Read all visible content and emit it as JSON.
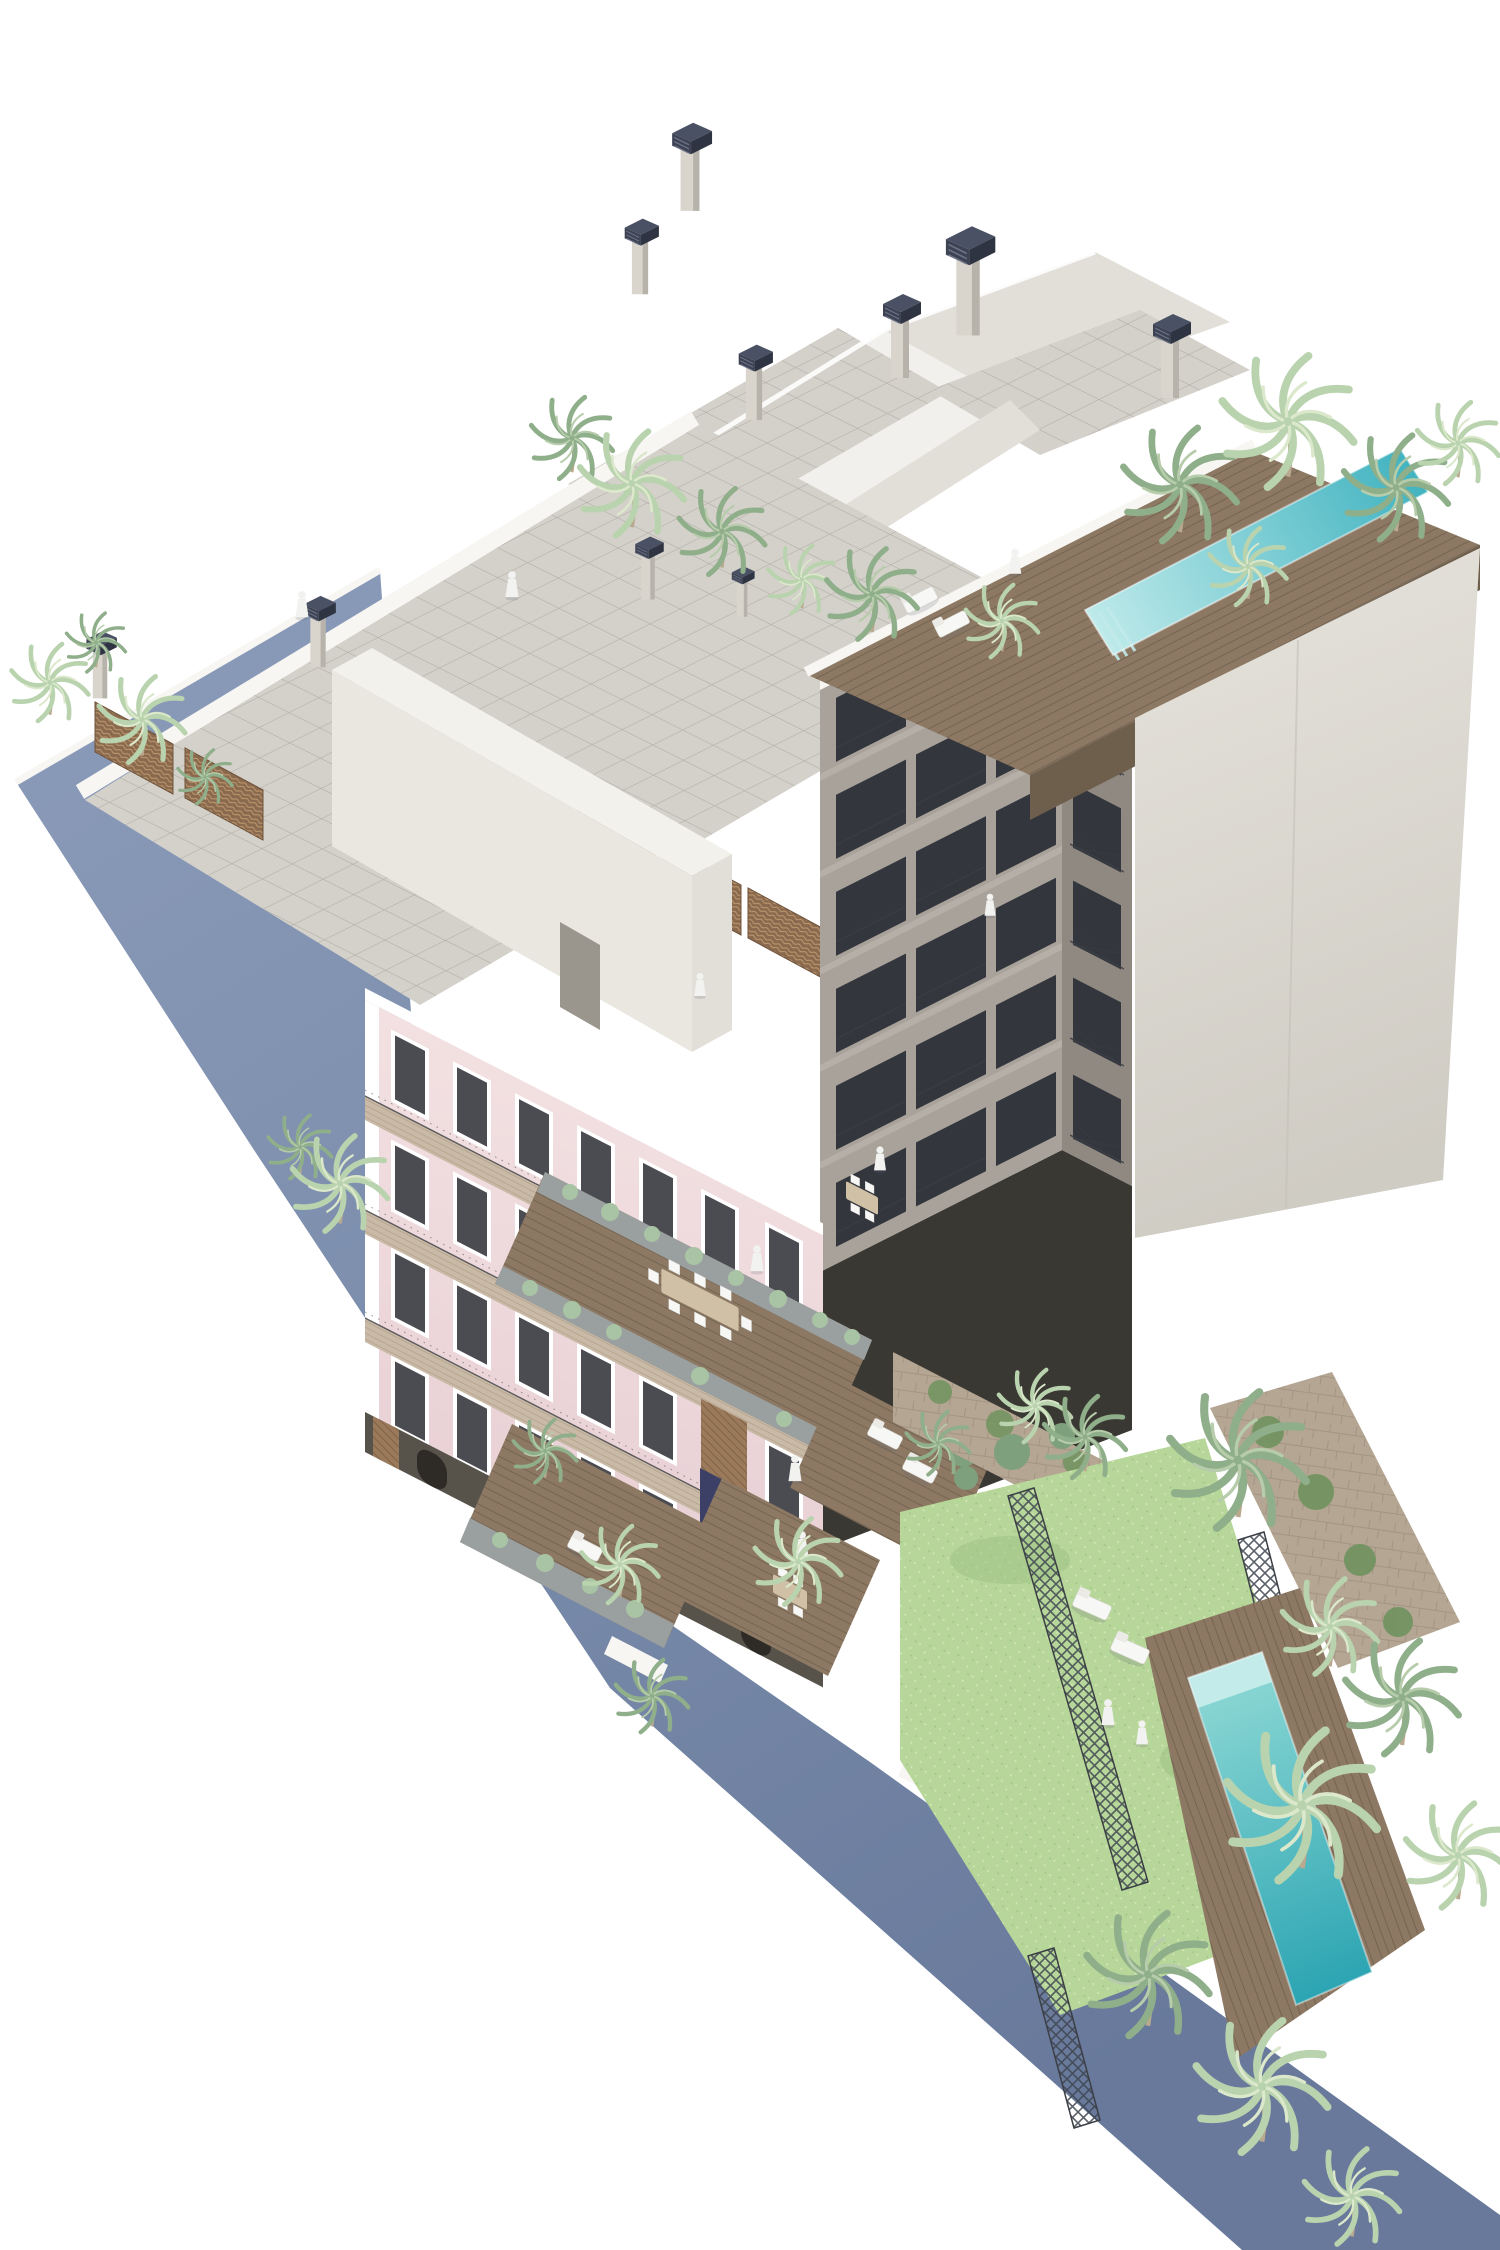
{
  "image_type": "architectural-3d-rendering",
  "scene": {
    "description_elements": [
      "blue-boundary-wall",
      "pink-heritage-facade",
      "rooftop-tiled-terrace",
      "wicker-privacy-partitions",
      "rooftop-core-volume",
      "chimneys-with-dark-caps",
      "gray-courtyard-tower",
      "corner-balconies",
      "rooftop-wood-deck",
      "rooftop-lap-pool",
      "blank-party-wall",
      "courtyard-terraces",
      "planters",
      "outdoor-dining-tables",
      "sun-loungers",
      "white-statues",
      "white-figures",
      "garden-lawn",
      "steel-trellis-bands",
      "stone-walls-with-ivy",
      "garden-pool",
      "palm-trees"
    ],
    "statue_count": 4,
    "figure_count": 6,
    "pool_count": 2,
    "chimney_count": 10,
    "palm_count": 32
  },
  "colors": {
    "bg": "#ffffff",
    "blue_top": "#8c9cba",
    "blue_mid": "#7b8dac",
    "blue_low": "#68799b",
    "parapet": "#f7f6f3",
    "roof_white": "#f2f0ec",
    "roof_shadow": "#e2dfd8",
    "tile": "#d4d1ca",
    "tile_line": "#a39f98",
    "cream_core": "#eae7e0",
    "core_top": "#f3f1ec",
    "chimney_body": "#d9d5cd",
    "chimney_body_shade": "#b7b3ab",
    "chimney_cap": "#3e4354",
    "chimney_cap_top": "#4a5164",
    "chimney_cap_side": "#2f3443",
    "chimney_cap_lines": "#6d7488",
    "pink": "#f3e1e2",
    "pink_low": "#e8d0d5",
    "white_trim": "#ffffff",
    "cornice": "#c9baa7",
    "cornice_line": "#a08b72",
    "window_dark": "#4b4b52",
    "brick": "#9b7a5c",
    "brick_line": "#7c5c40",
    "tower_gray": "#a8a29a",
    "tower_gray_light": "#b5afa7",
    "tower_gray_dark": "#8f8982",
    "opening_dark": "#33363d",
    "railing": "#3c3f45",
    "party_wall_a": "#e6e3dc",
    "party_wall_b": "#cfccc4",
    "deck_wood": "#8d7963",
    "deck_wood_dark": "#6e5e4c",
    "deck_wood_line": "#5f5242",
    "pool_light": "#c2ebea",
    "pool_near": "#8fd9d5",
    "pool_far": "#2ba4b2",
    "pool_roof_near": "#bfeaea",
    "pool_roof_far": "#41b3c0",
    "lawn": "#b7d699",
    "lawn_light": "#d2e5b4",
    "lawn_shade": "#9cc083",
    "stone": "#b4a692",
    "stone_line": "#9c8d7a",
    "ivy": "#70935f",
    "planter": "#9aa0a0",
    "plant_sage": "#a9c4a4",
    "plant_deep": "#7fa07c",
    "palm_light_a": "#b9d3ae",
    "palm_light_b": "#dbe8cb",
    "palm_deep_a": "#8fae8a",
    "palm_deep_b": "#b6ccab",
    "trunk": "#b9a98f",
    "furniture_white": "#f7f7f5",
    "table_wood": "#cfc0a6",
    "statue": "#f2f2f0",
    "navy_door": "#3c4066",
    "ground_dark": "#57534b",
    "ground_arch": "#2e2b27",
    "courtyard_dark": "#3a3833",
    "shadow": "rgba(90,95,110,0.18)"
  }
}
